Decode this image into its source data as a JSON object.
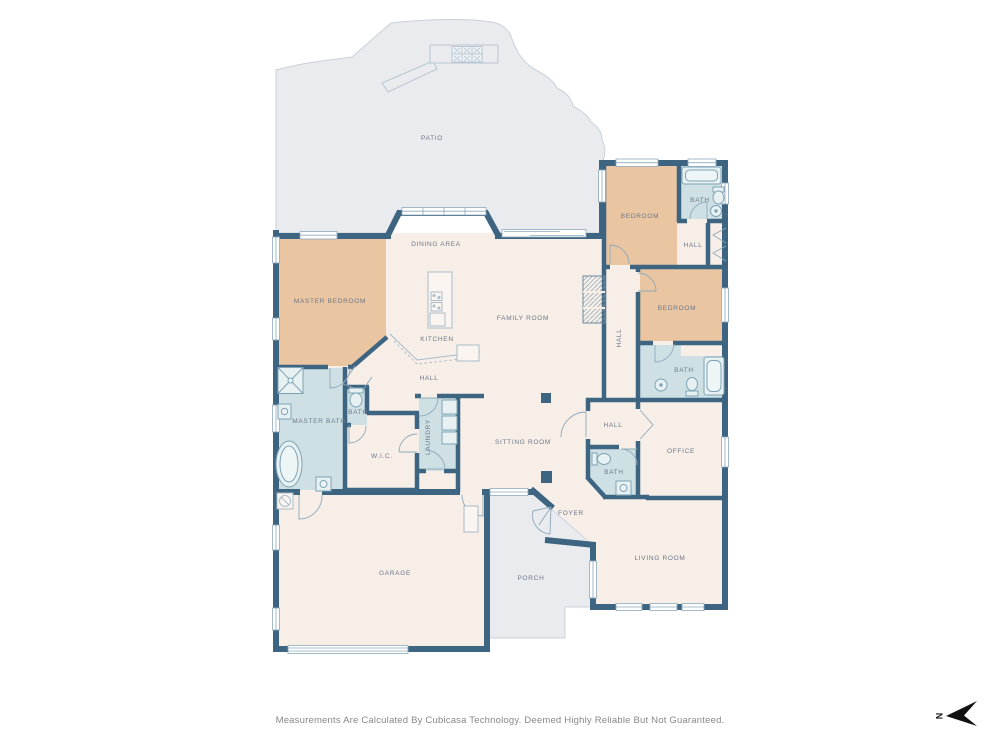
{
  "floorplan": {
    "rooms": {
      "patio": "PATIO",
      "master_bedroom": "MASTER BEDROOM",
      "dining_area": "DINING AREA",
      "kitchen": "KITCHEN",
      "family_room": "FAMILY ROOM",
      "bedroom_top": "BEDROOM",
      "bath_top": "BATH",
      "hall_top": "HALL",
      "bedroom_right": "BEDROOM",
      "hall_mid": "HALL",
      "bath_mid": "BATH",
      "hall_center": "HALL",
      "master_bath": "MASTER BATH",
      "bath_small": "BATH",
      "wic": "W.I.C.",
      "laundry": "LAUNDRY",
      "sitting_room": "SITTING ROOM",
      "hall_office": "HALL",
      "bath_foyer": "BATH",
      "office": "OFFICE",
      "foyer": "FOYER",
      "living_room": "LIVING ROOM",
      "garage": "GARAGE",
      "porch": "PORCH"
    },
    "footer": {
      "disclaimer": "Measurements Are Calculated By Cubicasa Technology. Deemed Highly Reliable But Not Guaranteed."
    },
    "compass": {
      "north_letter": "N"
    },
    "colors": {
      "wall": "#3d6480",
      "room_floor": "#f6eee7",
      "bedroom_fill": "#e9c5a2",
      "bath_fill": "#cee0e4",
      "outdoor_fill": "#e9ebee",
      "fixture_stroke": "#7ea3b6",
      "label_text": "#6e7788"
    }
  }
}
